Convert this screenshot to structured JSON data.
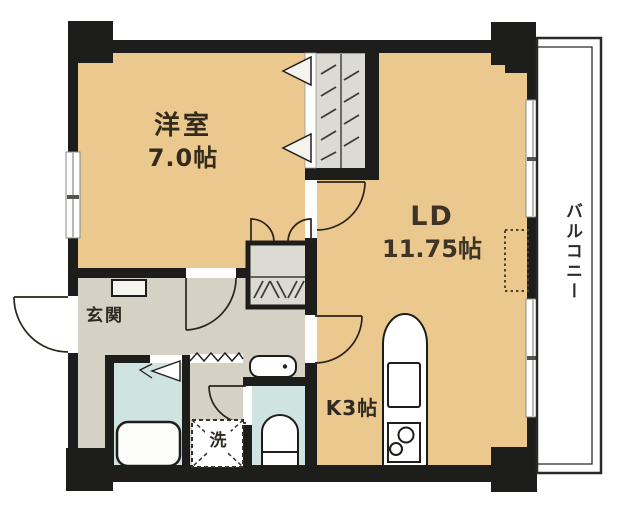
{
  "plan": {
    "rooms": {
      "western": {
        "name": "洋室",
        "size": "7.0帖"
      },
      "ld": {
        "name": "LD",
        "size": "11.75帖"
      },
      "kitchen": {
        "label": "K3帖"
      },
      "balcony": {
        "label": "バルコニー"
      },
      "entrance": {
        "label": "玄関"
      },
      "washer": {
        "label": "洗"
      }
    },
    "colors": {
      "room": "#ebc88e",
      "hall": "#d6d1c5",
      "wet": "#cfe3e1",
      "closet": "#dbdbd3",
      "wall": "#1d1d1b",
      "window": "#ffffff"
    }
  }
}
